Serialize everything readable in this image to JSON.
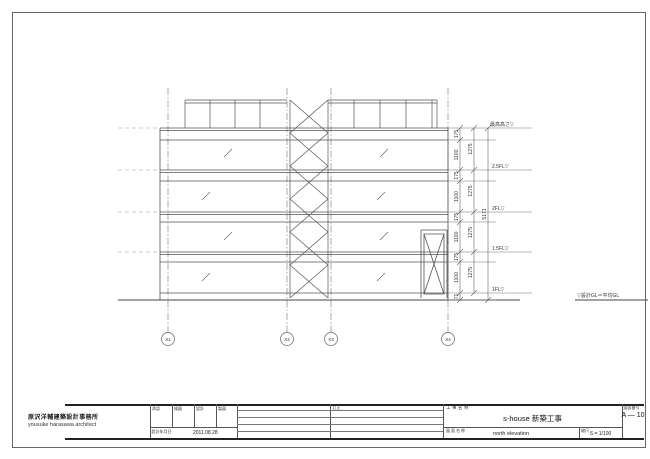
{
  "sheet": {
    "levels": [
      "最高高さ▽",
      "2.5FL▽",
      "2FL▽",
      "1.5FL▽",
      "1FL▽"
    ],
    "gl_label": "▽設計GL＝平均GL",
    "dims": {
      "inner": [
        "175",
        "1100",
        "175",
        "1100",
        "175",
        "1100",
        "175",
        "1100",
        "71"
      ],
      "story": [
        "1275",
        "1275",
        "1275",
        "1275"
      ],
      "total": "5171"
    },
    "grids": [
      "X1",
      "X2",
      "X3",
      "X4"
    ]
  },
  "title_block": {
    "architect_jp": "原沢洋輔建築設計事務所",
    "architect_en": "yousuke harasawa architect",
    "approvals": [
      "承認",
      "検図",
      "設計",
      "製図"
    ],
    "date_label": "設計年月日",
    "date": "2011.08.28",
    "revision_label": "訂正",
    "project_label": "工事名称",
    "project_name": "s-house 新築工事",
    "drawing_label": "図面名称",
    "drawing_name": "north elevation",
    "scale_label": "縮尺",
    "scale": "S = 1/100",
    "number_label": "図面番号",
    "number": "A — 10"
  },
  "colors": {
    "line": "#555",
    "ink": "#222"
  }
}
